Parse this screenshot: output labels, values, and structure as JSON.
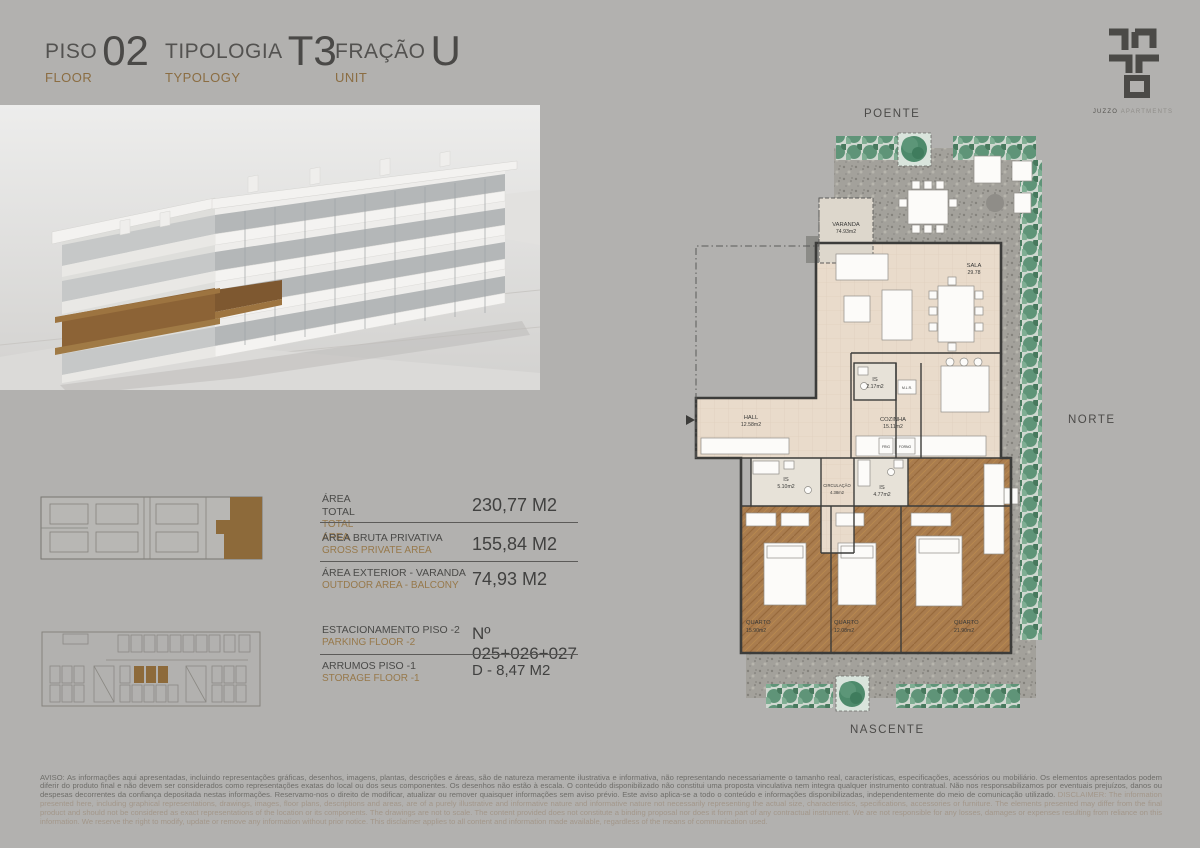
{
  "header": {
    "fields": [
      {
        "label": "PISO",
        "value": "02",
        "sublabel": "FLOOR"
      },
      {
        "label": "TIPOLOGIA",
        "value": "T3",
        "sublabel": "TYPOLOGY"
      },
      {
        "label": "FRAÇÃO",
        "value": "U",
        "sublabel": "UNIT"
      }
    ],
    "logo": {
      "brand": "JUZZO",
      "brand_suffix": "APARTMENTS"
    }
  },
  "specs": {
    "areas": [
      {
        "label_pt": "ÁREA TOTAL",
        "label_en": "TOTAL AREA",
        "value": "230,77 M2"
      },
      {
        "label_pt": "ÁREA BRUTA PRIVATIVA",
        "label_en": "GROSS PRIVATE AREA",
        "value": "155,84 M2"
      },
      {
        "label_pt": "ÁREA EXTERIOR - VARANDA",
        "label_en": "OUTDOOR AREA - BALCONY",
        "value": "74,93 M2"
      }
    ],
    "details": [
      {
        "label_pt": "ESTACIONAMENTO PISO -2",
        "label_en": "PARKING FLOOR -2",
        "value": "Nº 025+026+027"
      },
      {
        "label_pt": "ARRUMOS PISO -1",
        "label_en": "STORAGE FLOOR -1",
        "value": "D - 8,47 M2"
      }
    ]
  },
  "floor_plan": {
    "compass": {
      "top": "POENTE",
      "right": "NORTE",
      "bottom": "NASCENTE"
    },
    "rooms": [
      {
        "name": "VARANDA",
        "area": "74.93m2"
      },
      {
        "name": "SALA",
        "area": "29.78"
      },
      {
        "name": "HALL",
        "area": "12.58m2"
      },
      {
        "name": "IS",
        "area": "2.17m2"
      },
      {
        "name": "COZINHA",
        "area": "15.11m2"
      },
      {
        "name": "IS",
        "area": "5.10m2"
      },
      {
        "name": "CIRCULAÇÃO",
        "area": "4.38m2"
      },
      {
        "name": "IS",
        "area": "4.77m2"
      },
      {
        "name": "QUARTO",
        "area": "15.90m2"
      },
      {
        "name": "QUARTO",
        "area": "12.08m2"
      },
      {
        "name": "QUARTO",
        "area": "21.90m2"
      }
    ],
    "appliances": {
      "fridge": "FRIG",
      "oven": "FORNO",
      "washer": "M.L.R."
    }
  },
  "disclaimer": {
    "pt": "AVISO: As informações aqui apresentadas, incluindo representações gráficas, desenhos, imagens, plantas, descrições e áreas, são de natureza meramente ilustrativa e informativa, não representando necessariamente o tamanho real, características, especificações, acessórios ou mobiliário. Os elementos apresentados podem diferir do produto final e não devem ser considerados como representações exatas do local ou dos seus componentes. Os desenhos não estão à escala. O conteúdo disponibilizado não constitui uma proposta vinculativa nem integra qualquer instrumento contratual. Não nos responsabilizamos por eventuais prejuízos, danos ou despesas decorrentes da confiança depositada nestas informações. Reservamo-nos o direito de modificar, atualizar ou remover quaisquer informações sem aviso prévio. Este aviso aplica-se a todo o conteúdo e informações disponibilizadas, independentemente do meio de comunicação utilizado.",
    "en": "DISCLAIMER: The information presented here, including graphical representations, drawings, images, floor plans, descriptions and areas, are of a purely illustrative and informative nature and informative nature not necessarily representing the actual size, characteristics, specifications, accessories or furniture. The elements presented may differ from the final product and should not be considered as exact representations of the location or its components. The drawings are not to scale. The content provided does not constitute a binding proposal nor does it form part of any contractual instrument. We are not responsible for any losses, damages or expenses resulting from reliance on this information. We reserve the right to modify, update or remove any information without prior notice. This disclaimer applies to all content and information made available, regardless of the means of communication used."
  },
  "colors": {
    "background": "#B2B1AF",
    "accent_gold": "#8B6D42",
    "unit_brown": "#8D6A3A",
    "hedge_green": "#5F9478",
    "wood_floor": "#A97C4E",
    "interior_floor": "#E9DBCB",
    "text_dark": "#454545"
  }
}
